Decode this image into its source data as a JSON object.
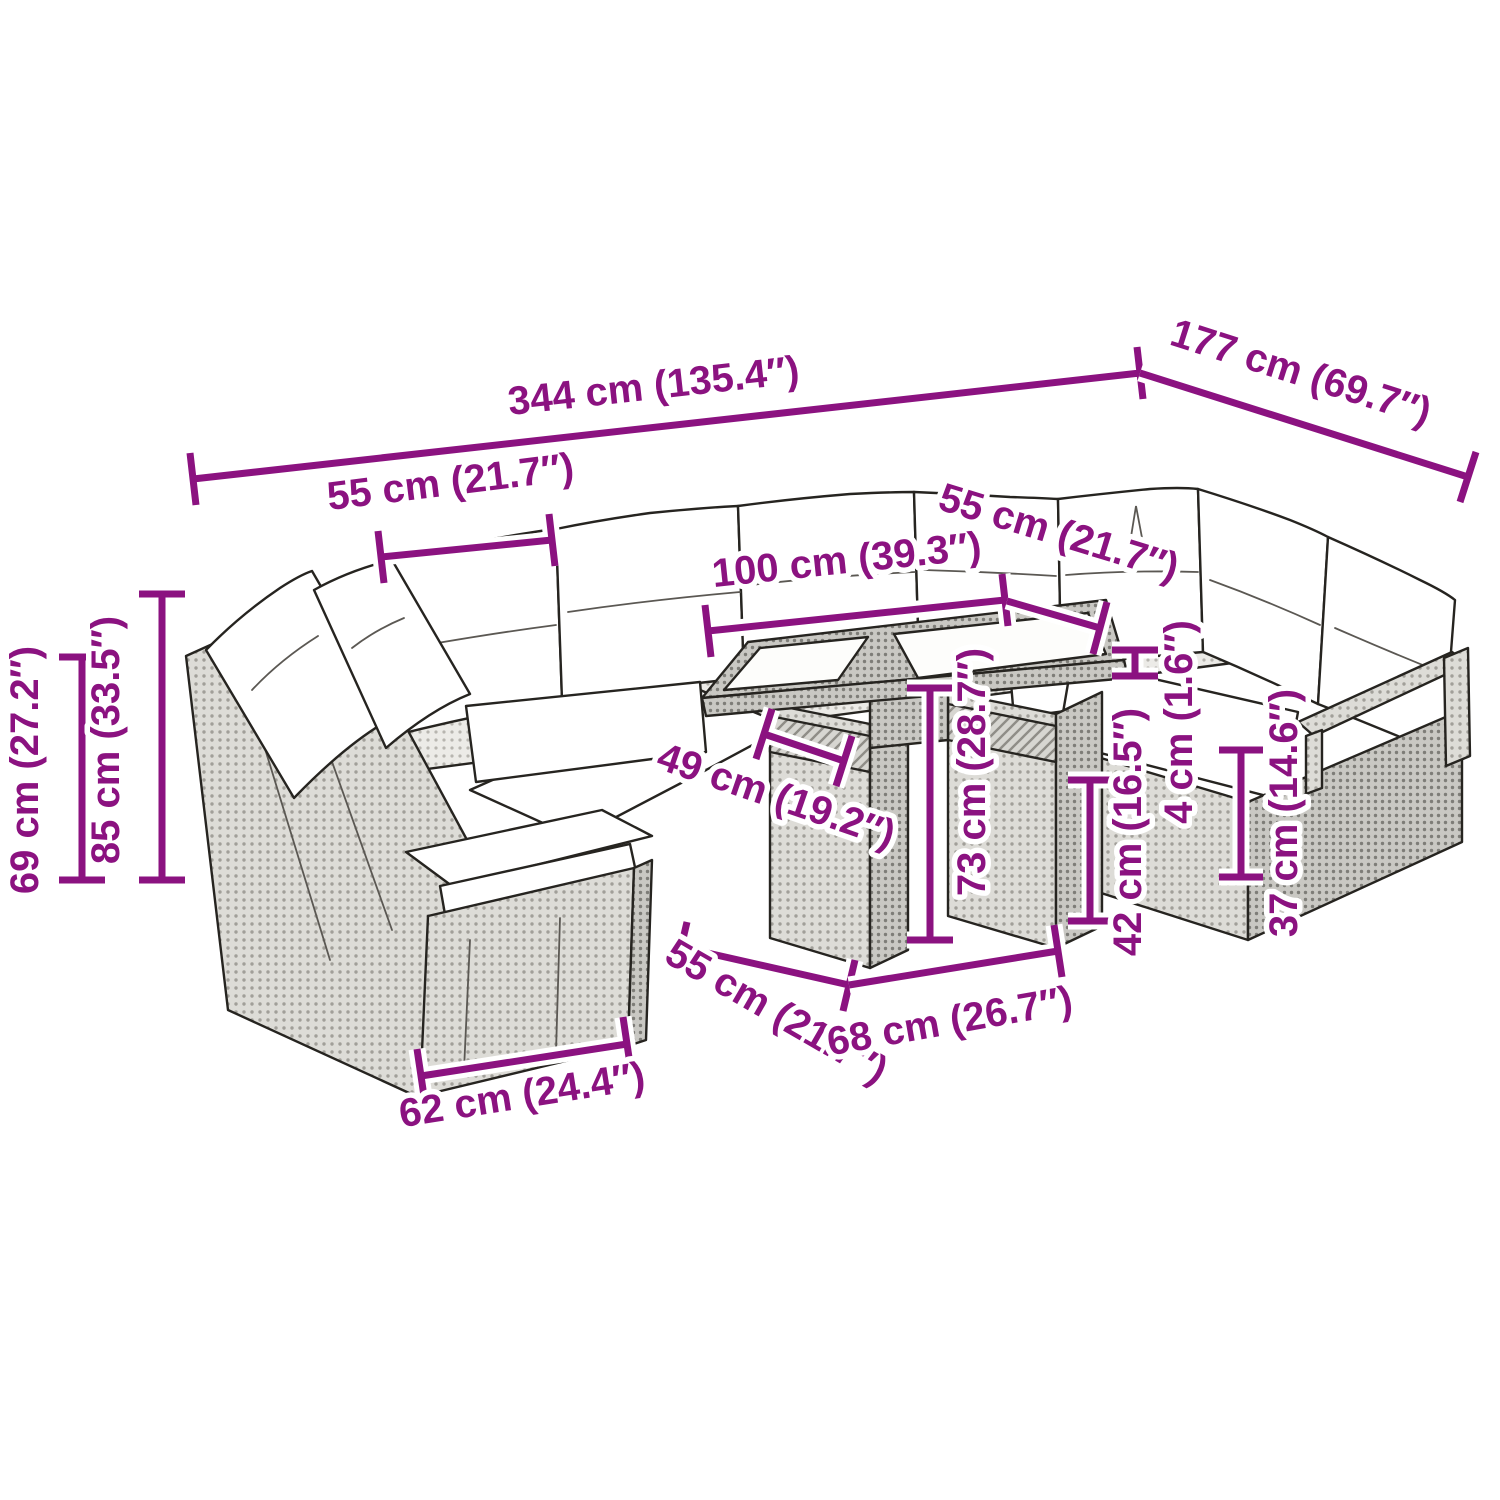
{
  "diagram": {
    "type": "product dimension diagram",
    "subject": "rattan garden lounge set with cushions and cube table",
    "colors": {
      "background": "#ffffff",
      "dimension_accent": "#8b1280",
      "outline": "#262420",
      "rattan_light": "#ecebe7",
      "rattan_mid": "#dddcd7",
      "rattan_dark": "#c9c8c3",
      "cushion": "#ffffff"
    },
    "dimensions": {
      "overall_width": "344 cm (135.4″)",
      "overall_depth": "177 cm (69.7″)",
      "seat_module_width": "55 cm (21.7″)",
      "corner_seat_width": "55 cm (21.7″)",
      "table_top_length": "100 cm (39.3″)",
      "backrest_height": "69 cm (27.2″)",
      "total_height": "85 cm (33.5″)",
      "table_overhang": "49 cm (19.2″)",
      "table_height": "73 cm (28.7″)",
      "table_base_depth": "55 cm (21.7″)",
      "table_base_length": "68 cm (26.7″)",
      "module_depth": "62 cm (24.4″)",
      "seat_height": "42 cm (16.5″)",
      "tabletop_thickness": "4 cm (1.6″)",
      "front_frame_height": "37 cm (14.6″)"
    }
  }
}
